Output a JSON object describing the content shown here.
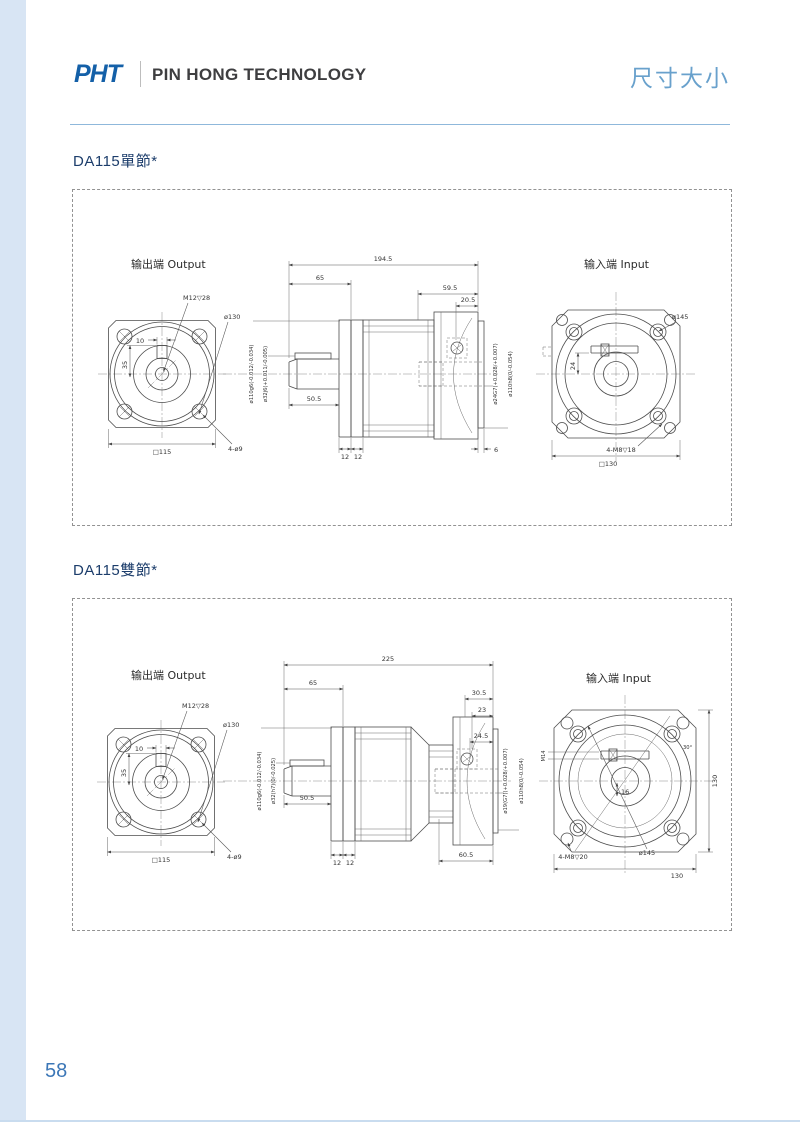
{
  "header": {
    "logo": "PHT",
    "company": "PIN HONG TECHNOLOGY",
    "page_title": "尺寸大小"
  },
  "page": {
    "number": "58"
  },
  "sections": [
    {
      "title": "DA115單節*",
      "output_view": {
        "label": "输出端 Output",
        "keyway_width": "10",
        "keyway_height": "35",
        "tap": "M12▽28",
        "pilot": "ø130",
        "square": "□115",
        "corner_holes": "4-ø9"
      },
      "side_view": {
        "overall": "194.5",
        "front_depth": "65",
        "shaft_len": "50.5",
        "rear_depth": "59.5",
        "rear_inner": "20.5",
        "ring1": "12",
        "ring2": "12",
        "step": "6",
        "pilot_dia": "ø110g6(-0.012/-0.034)",
        "shaft_dia": "ø32j6(+0.011/-0.005)",
        "input_bore": "ø24G7(+0.028/+0.007)",
        "input_pilot": "ø110h8(0/-0.054)"
      },
      "input_view": {
        "label": "输入端 Input",
        "bcd": "ø145",
        "slot_offset": "24",
        "mount_holes": "4-M8▽18",
        "square": "□130"
      }
    },
    {
      "title": "DA115雙節*",
      "output_view": {
        "label": "输出端 Output",
        "keyway_width": "10",
        "keyway_height": "35",
        "tap": "M12▽28",
        "pilot": "ø130",
        "square": "□115",
        "corner_holes": "4-ø9"
      },
      "side_view": {
        "overall": "225",
        "front_depth": "65",
        "shaft_len": "50.5",
        "rear_depth": "30.5",
        "rear_mid": "23",
        "rear_inner": "24.5",
        "ring1": "12",
        "ring2": "12",
        "rear_total": "60.5",
        "pilot_dia": "ø110g6(-0.012/-0.034)",
        "shaft_dia": "ø32(h7)(0/-0.025)",
        "input_bore": "ø19(G7)(+0.028/+0.007)",
        "input_pilot": "ø110h8(0/-0.054)"
      },
      "input_view": {
        "label": "输入端 Input",
        "bcd": "ø145",
        "slot_offset": "16",
        "clamp": "M14",
        "angle": "30°",
        "mount_holes": "4-M8▽20",
        "width": "130",
        "height": "130"
      }
    }
  ]
}
